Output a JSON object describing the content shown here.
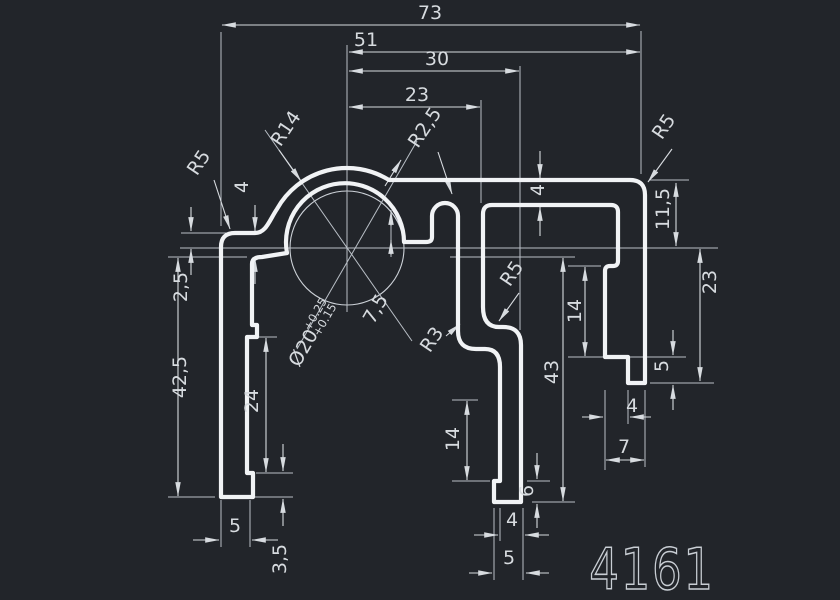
{
  "drawing": {
    "part_number": "4161",
    "background_color": "#22252a",
    "outline_color": "#f1f3f5",
    "dim_color": "#d7dbdf",
    "dims": {
      "w73": "73",
      "w51": "51",
      "w30": "30",
      "w23": "23",
      "r5_left": "R5",
      "r14": "R14",
      "r2_5": "R2,5",
      "r5_right": "R5",
      "t4_left": "4",
      "d2_5": "2,5",
      "h42_5": "42,5",
      "h24": "24",
      "w5_left": "5",
      "h3_5": "3,5",
      "dia20": "Ø20",
      "tol_plus": "+0.25",
      "tol_minus": "+0.15",
      "d7_5": "7,5",
      "t4_web": "4",
      "r5_mid": "R5",
      "r3": "R3",
      "h11_5": "11,5",
      "h23_right": "23",
      "h14_right": "14",
      "h5_right": "5",
      "w4_right": "4",
      "w7_right": "7",
      "h43": "43",
      "h14_mid": "14",
      "h6_mid": "6",
      "w4_mid": "4",
      "w5_mid": "5"
    }
  }
}
